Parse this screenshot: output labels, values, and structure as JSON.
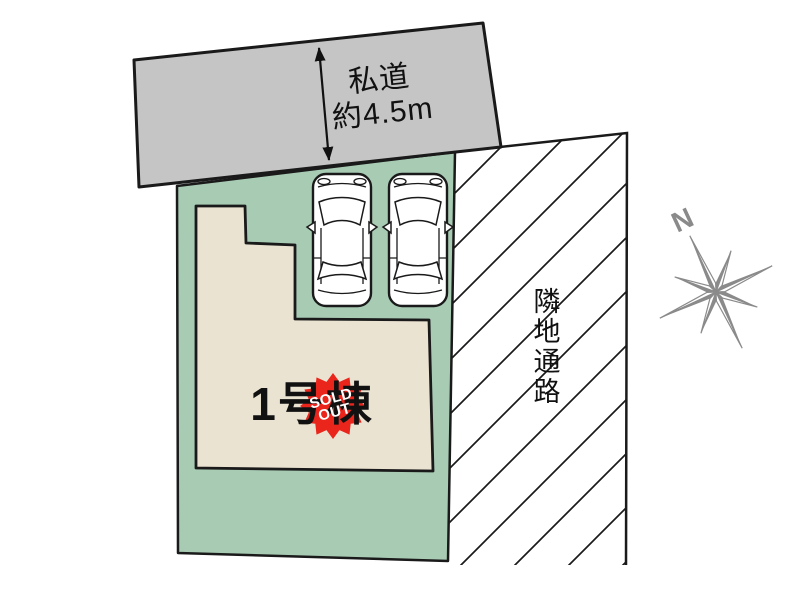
{
  "site_plan": {
    "road": {
      "label_line1": "私道",
      "label_line2": "約4.5m",
      "fill": "#c5c5c6"
    },
    "plot": {
      "fill": "#a8cbb4"
    },
    "building": {
      "label": "1号棟",
      "fill": "#ebe3d1"
    },
    "sold_out_badge": {
      "line1": "SOLD",
      "line2": "OUT",
      "fill": "#e9251c",
      "text_color": "#ffffff"
    },
    "passage": {
      "label": "隣地通路"
    },
    "compass": {
      "label": "N",
      "color": "#8a8a8a"
    }
  }
}
